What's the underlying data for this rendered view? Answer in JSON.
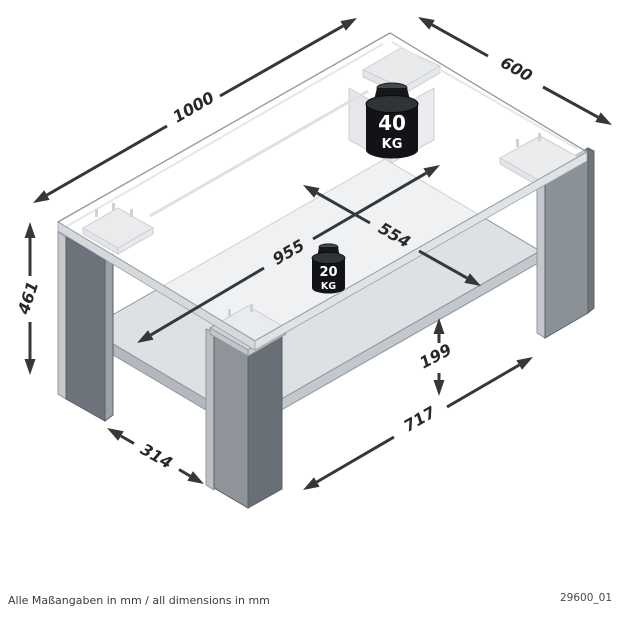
{
  "footer": {
    "units_note": "Alle Maßangaben in mm / all dimensions in mm",
    "drawing_number": "29600_01"
  },
  "dimensions_mm": {
    "tabletop_length": "1000",
    "tabletop_depth": "600",
    "table_height": "461",
    "inner_width": "955",
    "inner_depth": "554",
    "shelf_clearance": "199",
    "shelf_length": "717",
    "leg_depth": "314"
  },
  "max_load": {
    "tabletop": {
      "value": "40",
      "unit": "KG"
    },
    "shelf": {
      "value": "20",
      "unit": "KG"
    }
  },
  "style": {
    "dimension_line_color": "#34383b",
    "leg_color": "#6d747b",
    "glass_color": "#f2f4f5"
  }
}
